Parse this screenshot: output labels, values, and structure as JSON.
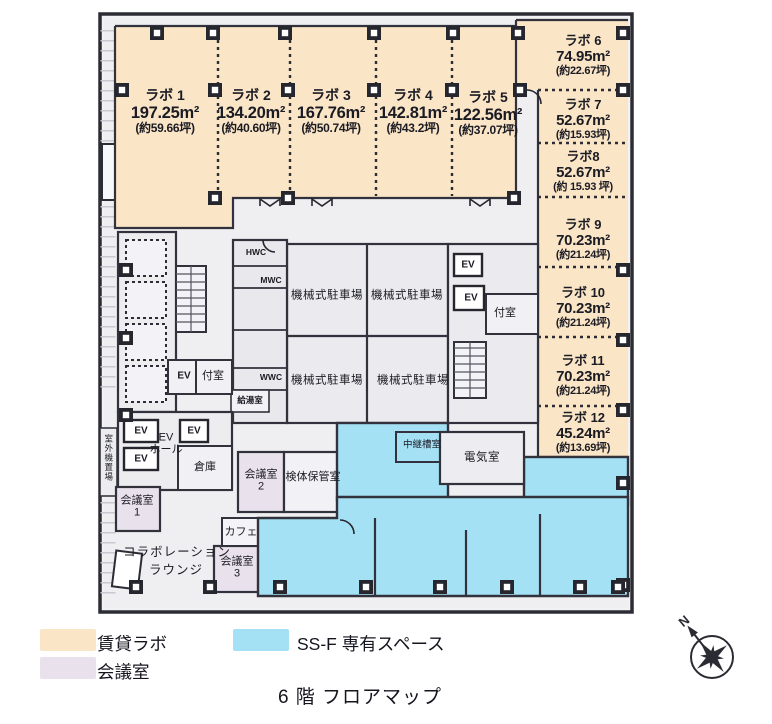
{
  "title": "6 階 フロアマップ",
  "compass": {
    "north": "N"
  },
  "colors": {
    "rental_lab": "#FAE5C6",
    "meeting_room": "#E9E1EB",
    "ssf_space": "#A5E1F5",
    "common": "#EFEEF1",
    "wall": "#32323C"
  },
  "legend": {
    "rental_lab": "賃貸ラボ",
    "meeting_room": "会議室",
    "ssf_space": "SS-F 専有スペース"
  },
  "labs": [
    {
      "name": "ラボ 1",
      "area": "197.25m²",
      "tsubo": "(約59.66坪)"
    },
    {
      "name": "ラボ 2",
      "area": "134.20m²",
      "tsubo": "(約40.60坪)"
    },
    {
      "name": "ラボ 3",
      "area": "167.76m²",
      "tsubo": "(約50.74坪)"
    },
    {
      "name": "ラボ 4",
      "area": "142.81m²",
      "tsubo": "(約43.2坪)"
    },
    {
      "name": "ラボ 5",
      "area": "122.56m²",
      "tsubo": "(約37.07坪)"
    },
    {
      "name": "ラボ 6",
      "area": "74.95m²",
      "tsubo": "(約22.67坪)"
    },
    {
      "name": "ラボ 7",
      "area": "52.67m²",
      "tsubo": "(約15.93坪)"
    },
    {
      "name": "ラボ8",
      "area": "52.67m²",
      "tsubo": "(約 15.93 坪)"
    },
    {
      "name": "ラボ 9",
      "area": "70.23m²",
      "tsubo": "(約21.24坪)"
    },
    {
      "name": "ラボ 10",
      "area": "70.23m²",
      "tsubo": "(約21.24坪)"
    },
    {
      "name": "ラボ 11",
      "area": "70.23m²",
      "tsubo": "(約21.24坪)"
    },
    {
      "name": "ラボ 12",
      "area": "45.24m²",
      "tsubo": "(約13.69坪)"
    }
  ],
  "rooms": {
    "parking": "機械式駐車場",
    "ev": "EV",
    "ev_hall_1": "EV",
    "ev_hall_2": "ホール",
    "storage": "倉庫",
    "anteroom": "付室",
    "meeting": "会議室",
    "meeting_no_1": "1",
    "meeting_no_2": "2",
    "meeting_no_3": "3",
    "specimen": "検体保管室",
    "relay_tank": "中継槽室",
    "electrical": "電気室",
    "collab_1": "コラボレーション",
    "collab_2": "ラウンジ",
    "cafe": "カフェ",
    "hwc": "HWC",
    "mwc": "MWC",
    "wwc": "WWC",
    "hot_water": "給湯室",
    "outdoor_unit": "室外機置場"
  }
}
